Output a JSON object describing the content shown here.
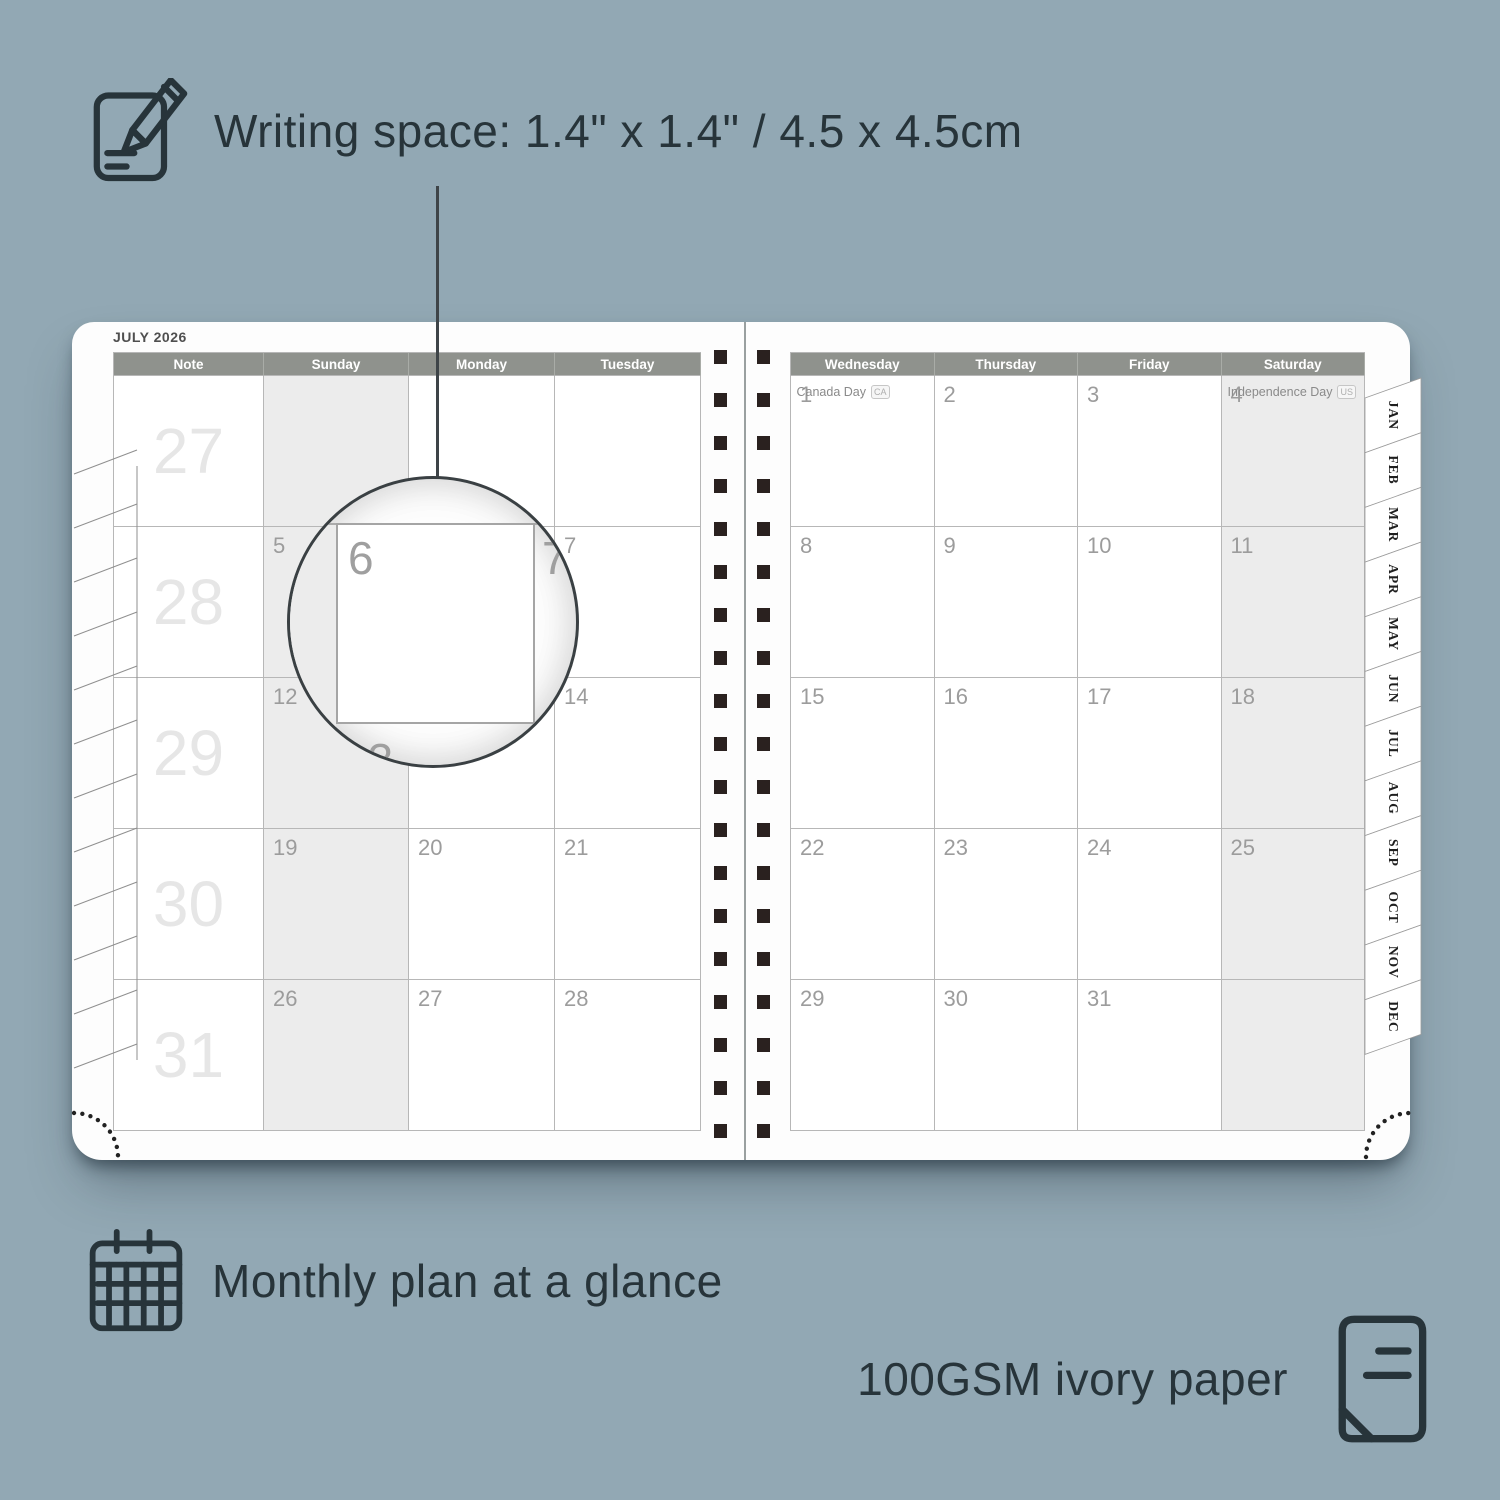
{
  "annotations": {
    "writing_space": "Writing space: 1.4\" x 1.4\" / 4.5 x 4.5cm",
    "monthly_plan": "Monthly plan at a glance",
    "paper_quality": "100GSM ivory paper"
  },
  "planner": {
    "title": "JULY 2026",
    "left_headers": [
      "Note",
      "Sunday",
      "Monday",
      "Tuesday"
    ],
    "right_headers": [
      "Wednesday",
      "Thursday",
      "Friday",
      "Saturday"
    ],
    "week_numbers": [
      "27",
      "28",
      "29",
      "30",
      "31"
    ],
    "left_rows": [
      [
        "",
        "",
        ""
      ],
      [
        "5",
        "6",
        "7"
      ],
      [
        "12",
        "13",
        "14"
      ],
      [
        "19",
        "20",
        "21"
      ],
      [
        "26",
        "27",
        "28"
      ]
    ],
    "right_rows": [
      [
        "1",
        "2",
        "3",
        "4"
      ],
      [
        "8",
        "9",
        "10",
        "11"
      ],
      [
        "15",
        "16",
        "17",
        "18"
      ],
      [
        "22",
        "23",
        "24",
        "25"
      ],
      [
        "29",
        "30",
        "31",
        ""
      ]
    ],
    "holidays": [
      {
        "day": "1",
        "label": "Canada Day",
        "badge": "CA"
      },
      {
        "day": "4",
        "label": "Independence Day",
        "badge": "US"
      }
    ],
    "month_tabs": [
      "JAN",
      "FEB",
      "MAR",
      "APR",
      "MAY",
      "JUN",
      "JUL",
      "AUG",
      "SEP",
      "OCT",
      "NOV",
      "DEC"
    ],
    "magnifier": {
      "day": "6",
      "adjacent_day": "7",
      "next_week_day": "13"
    }
  },
  "colors": {
    "background": "#92a8b4",
    "text_dark": "#27343a",
    "page_white": "#fdfdfd",
    "header_gray": "#8f928d",
    "grid_line": "#b7b7b7",
    "weekend_fill": "#ececec",
    "date_gray": "#9c9c9c",
    "weeknum_gray": "#e6e6e6",
    "spiral_dark": "#2a211f"
  }
}
